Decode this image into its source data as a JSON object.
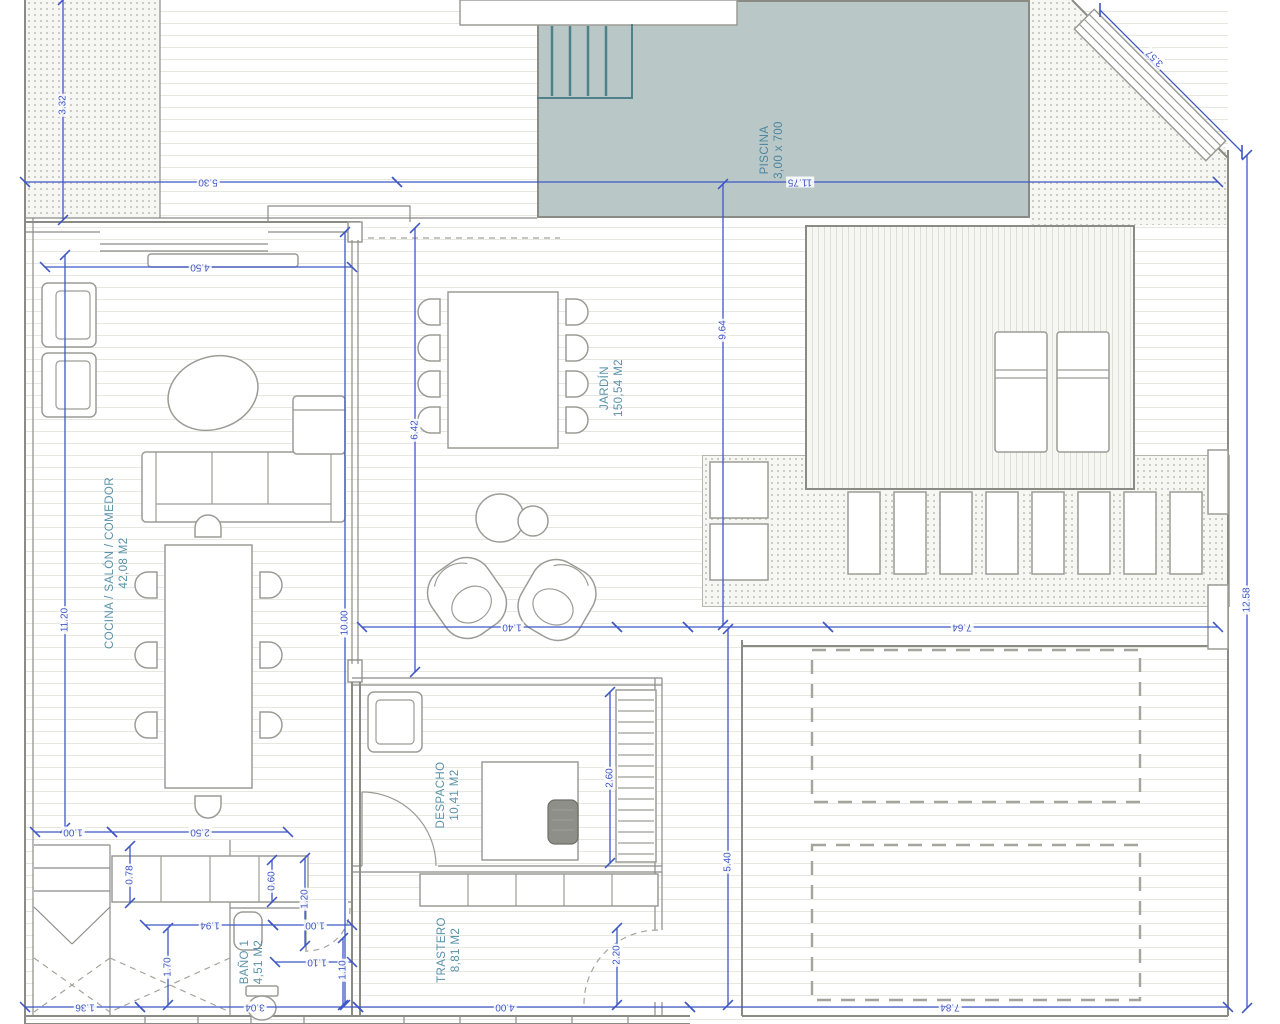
{
  "drawing": {
    "type": "floor-plan"
  },
  "colors": {
    "dimension_blue": "#3f57c5",
    "label_teal": "#5a91a9",
    "wall_gray": "#8b8b86",
    "pool_fill": "#b9c8c6",
    "pool_steps": "#50808a"
  },
  "rooms": {
    "cocina": {
      "name": "COCINA / SALÓN / COMEDOR",
      "area": "42,08 M2"
    },
    "jardin": {
      "name": "JARDÍN",
      "area": "150,54 M2"
    },
    "piscina": {
      "name": "PISCINA",
      "size": "3,00 x 700"
    },
    "despacho": {
      "name": "DESPACHO",
      "area": "10,41 M2"
    },
    "trastero": {
      "name": "TRASTERO",
      "area": "8,81 M2"
    },
    "bano": {
      "name": "BAÑO 1",
      "area": "4,51 M2"
    }
  },
  "dimensions": [
    {
      "label": "3.32",
      "x1": 63,
      "y1": 0,
      "x2": 63,
      "y2": 220,
      "lx": 63,
      "ly": 105,
      "rot": -90
    },
    {
      "label": "5.30",
      "x1": 25,
      "y1": 182,
      "x2": 397,
      "y2": 182,
      "lx": 208,
      "ly": 182,
      "rot": 180
    },
    {
      "label": "11.75",
      "x1": 397,
      "y1": 182,
      "x2": 1218,
      "y2": 182,
      "lx": 800,
      "ly": 182,
      "rot": 180
    },
    {
      "label": "3.57",
      "x1": 1100,
      "y1": 10,
      "x2": 1242,
      "y2": 152,
      "lx": 1155,
      "ly": 58,
      "rot": 225
    },
    {
      "label": "4.50",
      "x1": 45,
      "y1": 267,
      "x2": 352,
      "y2": 267,
      "lx": 200,
      "ly": 267,
      "rot": 180
    },
    {
      "label": "11.20",
      "x1": 65,
      "y1": 255,
      "x2": 65,
      "y2": 828,
      "lx": 65,
      "ly": 620,
      "rot": -90
    },
    {
      "label": "10.00",
      "x1": 345,
      "y1": 232,
      "x2": 345,
      "y2": 1005,
      "lx": 345,
      "ly": 623,
      "rot": -90
    },
    {
      "label": "6.42",
      "x1": 415,
      "y1": 228,
      "x2": 415,
      "y2": 672,
      "lx": 415,
      "ly": 430,
      "rot": -90
    },
    {
      "label": "9.64",
      "x1": 723,
      "y1": 184,
      "x2": 723,
      "y2": 625,
      "lx": 723,
      "ly": 330,
      "rot": -90
    },
    {
      "label": "",
      "x1": 362,
      "y1": 627,
      "x2": 617,
      "y2": 627
    },
    {
      "label": "1.40",
      "x1": 617,
      "y1": 627,
      "x2": 688,
      "y2": 627,
      "lx": 512,
      "ly": 627,
      "rot": 180
    },
    {
      "label": "",
      "x1": 688,
      "y1": 627,
      "x2": 828,
      "y2": 627
    },
    {
      "label": "7.64",
      "x1": 828,
      "y1": 627,
      "x2": 1218,
      "y2": 627,
      "lx": 962,
      "ly": 627,
      "rot": 180
    },
    {
      "label": "5.40",
      "x1": 728,
      "y1": 629,
      "x2": 728,
      "y2": 1005,
      "lx": 728,
      "ly": 862,
      "rot": -90
    },
    {
      "label": "12.58",
      "x1": 1247,
      "y1": 155,
      "x2": 1247,
      "y2": 1008,
      "lx": 1247,
      "ly": 600,
      "rot": -90
    },
    {
      "label": "2.60",
      "x1": 610,
      "y1": 692,
      "x2": 610,
      "y2": 863,
      "lx": 610,
      "ly": 778,
      "rot": -90
    },
    {
      "label": "1.00",
      "x1": 35,
      "y1": 832,
      "x2": 112,
      "y2": 832,
      "lx": 73,
      "ly": 832,
      "rot": 180
    },
    {
      "label": "2.50",
      "x1": 112,
      "y1": 832,
      "x2": 288,
      "y2": 832,
      "lx": 200,
      "ly": 832,
      "rot": 180
    },
    {
      "label": "0.78",
      "x1": 130,
      "y1": 846,
      "x2": 130,
      "y2": 903,
      "lx": 130,
      "ly": 875,
      "rot": -90
    },
    {
      "label": "0.60",
      "x1": 272,
      "y1": 860,
      "x2": 272,
      "y2": 902,
      "lx": 272,
      "ly": 881,
      "rot": -90
    },
    {
      "label": "1.20",
      "x1": 305,
      "y1": 858,
      "x2": 305,
      "y2": 946,
      "lx": 305,
      "ly": 899,
      "rot": -90
    },
    {
      "label": "1.94",
      "x1": 145,
      "y1": 925,
      "x2": 273,
      "y2": 925,
      "lx": 210,
      "ly": 925,
      "rot": 180
    },
    {
      "label": "1.00",
      "x1": 273,
      "y1": 925,
      "x2": 352,
      "y2": 925,
      "lx": 315,
      "ly": 925,
      "rot": 180
    },
    {
      "label": "1.10",
      "x1": 275,
      "y1": 962,
      "x2": 352,
      "y2": 962,
      "lx": 317,
      "ly": 962,
      "rot": 180
    },
    {
      "label": "1.70",
      "x1": 168,
      "y1": 928,
      "x2": 168,
      "y2": 1005,
      "lx": 168,
      "ly": 967,
      "rot": -90
    },
    {
      "label": "1.10",
      "x1": 343,
      "y1": 938,
      "x2": 343,
      "y2": 1005,
      "lx": 343,
      "ly": 970,
      "rot": -90
    },
    {
      "label": "2.20",
      "x1": 617,
      "y1": 928,
      "x2": 617,
      "y2": 1005,
      "lx": 617,
      "ly": 955,
      "rot": -90
    },
    {
      "label": "1.36",
      "x1": 25,
      "y1": 1007,
      "x2": 140,
      "y2": 1007,
      "lx": 85,
      "ly": 1007,
      "rot": 180
    },
    {
      "label": "3.04",
      "x1": 140,
      "y1": 1007,
      "x2": 358,
      "y2": 1007,
      "lx": 255,
      "ly": 1007,
      "rot": 180
    },
    {
      "label": "4.00",
      "x1": 358,
      "y1": 1007,
      "x2": 690,
      "y2": 1007,
      "lx": 505,
      "ly": 1007,
      "rot": 180
    },
    {
      "label": "7.84",
      "x1": 690,
      "y1": 1007,
      "x2": 1228,
      "y2": 1007,
      "lx": 950,
      "ly": 1007,
      "rot": 180
    }
  ]
}
